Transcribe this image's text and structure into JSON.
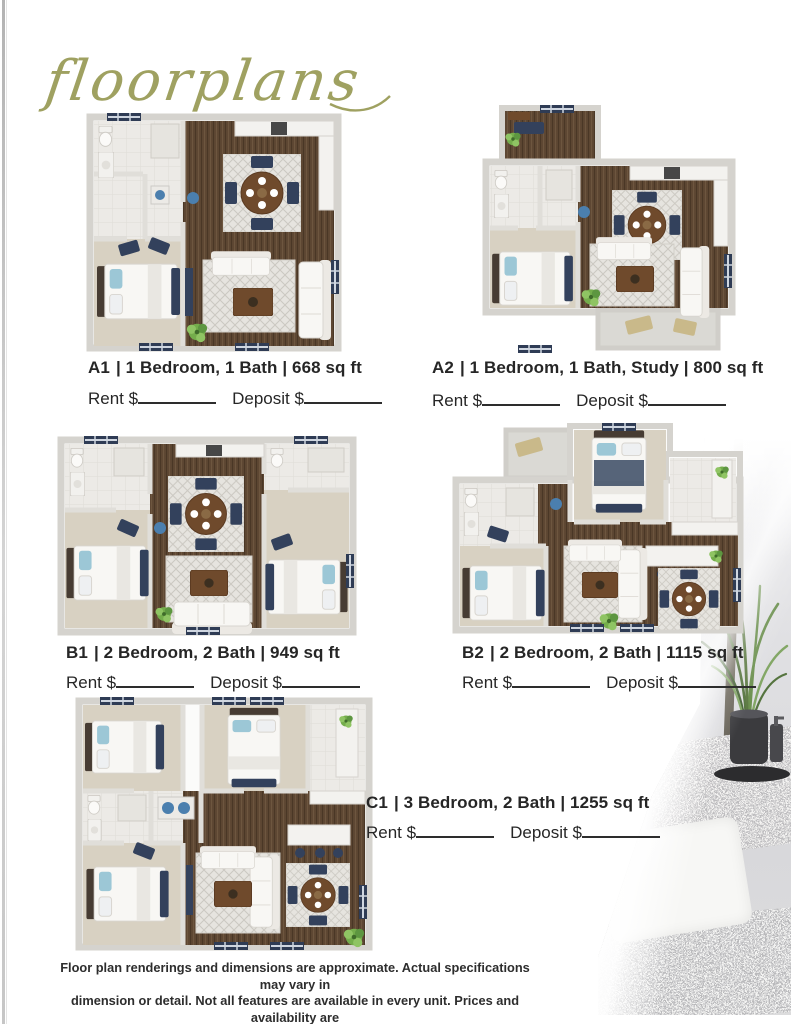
{
  "page_title": "floorplans",
  "units": [
    {
      "code": "A1",
      "details": "| 1 Bedroom, 1 Bath | 668 sq ft"
    },
    {
      "code": "A2",
      "details": "| 1 Bedroom, 1 Bath, Study | 800 sq ft"
    },
    {
      "code": "B1",
      "details": "| 2 Bedroom, 2 Bath | 949 sq ft"
    },
    {
      "code": "B2",
      "details": "| 2 Bedroom, 2 Bath | 1115 sq ft"
    },
    {
      "code": "C1",
      "details": "| 3 Bedroom, 2 Bath | 1255 sq ft"
    }
  ],
  "price_labels": {
    "rent": "Rent $",
    "deposit": "Deposit $"
  },
  "disclaimer": {
    "line1": "Floor plan renderings and dimensions are approximate. Actual specifications may vary in",
    "line2": "dimension or detail. Not all features are available in every unit. Prices and availability are",
    "line3": "subject to change. Please see a representative for details."
  },
  "colors": {
    "title_gold": "#9fa161",
    "wood_floor": "#5e4733",
    "carpet": "#d8d1c2",
    "navy_accent": "#33415c",
    "plant_green": "#74ad4b"
  }
}
